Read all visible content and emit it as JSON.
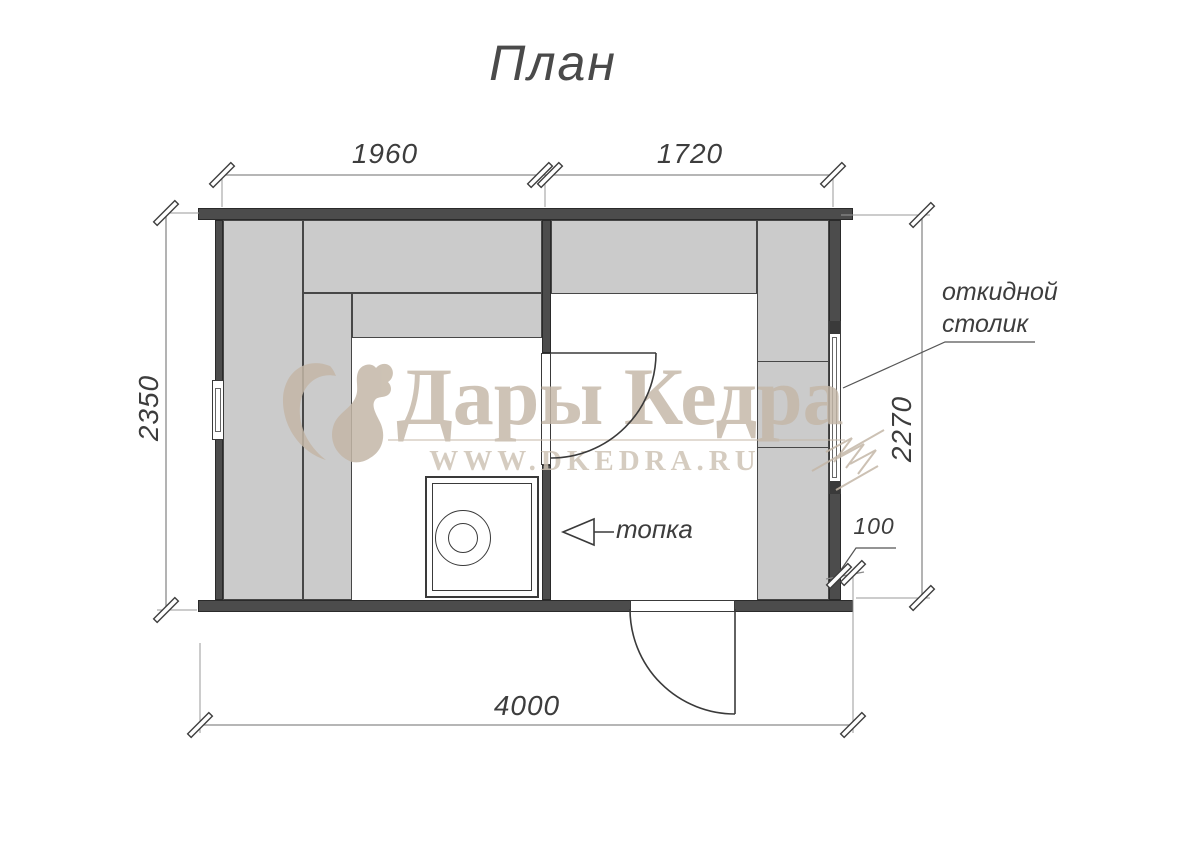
{
  "title": "План",
  "watermark": {
    "brand": "Дары Кедра",
    "url": "WWW.DKEDRA.RU"
  },
  "labels": {
    "folding_table_line1": "откидной",
    "folding_table_line2": "столик",
    "furnace": "топка"
  },
  "dimensions": {
    "top_left": "1960",
    "top_right": "1720",
    "left": "2350",
    "right": "2270",
    "bottom": "4000",
    "offset": "100"
  },
  "colors": {
    "wall": "#4c4c4c",
    "wall_edge": "#2a2a2a",
    "bench": "#cbcbcb",
    "bench_edge": "#474747",
    "line": "#3a3a3a",
    "dim_line": "#8a8a8a",
    "ext_line": "#9a9a9a",
    "dim_text": "#3d3d3d",
    "watermark": "#c4b7a7",
    "watermark_light": "#cdc2b3"
  }
}
